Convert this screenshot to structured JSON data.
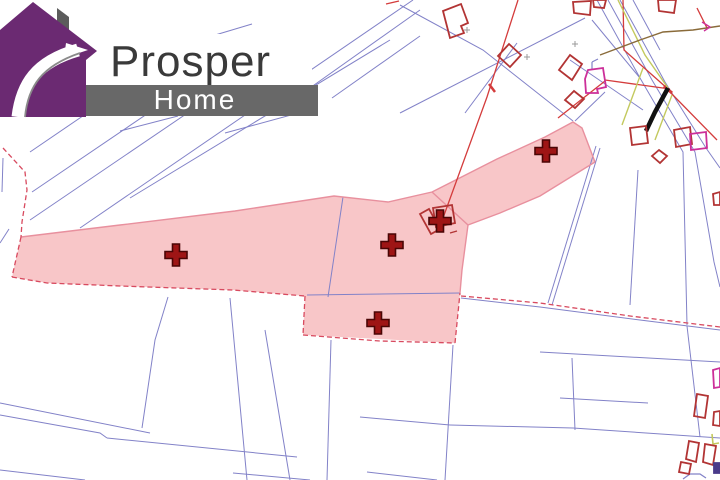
{
  "logo": {
    "title": "Prosper",
    "subtitle": "Home",
    "house_color": "#6b2a72",
    "chimney_color": "#5c5c5c",
    "banner_color": "#686868",
    "title_color": "#3a3a3a",
    "subtitle_color": "#ffffff",
    "swoosh_edge_color": "#8a8a8a"
  },
  "map": {
    "background": "#ffffff",
    "colors": {
      "parcel_line": "#8282c8",
      "highlight_fill": "#f8c6c8",
      "highlight_edge": "#e8909e",
      "highlight_dashed": "#d84a5f",
      "marker": "#9e1515",
      "marker_edge": "#4a0505",
      "building_red": "#b23434",
      "building_magenta": "#cc2f99",
      "building_purple": "#4a3a8a",
      "road_black": "#111111",
      "line_khaki": "#c3c95e",
      "line_brown": "#8a6b3a",
      "line_red": "#d43c3c",
      "tick_gray": "#9a9a9a"
    },
    "highlight_parcels": [
      "21,237 120,225 235,211 334,196 388,202 432,192 497,159 545,137 573,122 582,128 595,162 540,196 500,213 468,225 462,270 460,293 455,343 303,335 305,296 233,290 120,286 47,283 12,277"
    ],
    "outline_solid": [
      "21,237 120,225 235,211 334,196 388,202 432,192",
      "432,192 497,159 545,137 573,122 582,128 595,162",
      "595,162 540,196 500,213 468,225 462,270 460,293",
      "432,192 468,225"
    ],
    "dashed_lines": [
      "3,148 25,172 27,190 22,222 21,237",
      "21,237 12,277",
      "12,277 47,283 120,286 233,290 305,296",
      "305,296 303,335",
      "303,335 380,341 455,343",
      "455,343 460,293",
      "461,296 540,303 630,316 720,327"
    ],
    "parcel_lines": [
      "30,152 96,107",
      "32,192 200,78",
      "30,220 270,57",
      "80,228 413,0",
      "130,198 390,40",
      "175,47 252,24",
      "120,131 178,116",
      "225,133 302,112",
      "300,95 420,10",
      "332,98 420,36",
      "400,113 585,18",
      "400,5 483,50 573,121",
      "465,113 517,43",
      "605,92 575,121",
      "570,60 643,110",
      "592,20 640,78",
      "597,0 640,78 683,152 687,325",
      "608,0 652,80 695,152 714,262 720,287",
      "620,0 665,82 706,148 720,168",
      "633,0 660,50",
      "600,148 552,305",
      "596,146 548,303",
      "638,170 630,305",
      "461,298 540,307 640,320 720,330",
      "540,352 720,362",
      "560,398 648,403",
      "360,417 450,425",
      "450,425 573,428 720,438",
      "572,358 575,430",
      "687,326 700,437",
      "0,403 150,433",
      "0,415 100,433 107,438",
      "107,438 297,457",
      "168,297 155,340 142,428",
      "230,298 247,480",
      "265,330 290,480",
      "0,470 85,480",
      "233,473 310,480",
      "331,340 327,480",
      "453,345 445,480",
      "367,472 437,480",
      "3,158 2,192",
      "0,243 9,229",
      "343,197 328,297",
      "307,295 460,293"
    ],
    "extra_lines": [
      {
        "c": "line_red",
        "w": 1.3,
        "p": "518,0 487,97 443,218"
      },
      {
        "c": "line_red",
        "w": 2.5,
        "p": "489,84 495,92"
      },
      {
        "c": "line_red",
        "w": 1.3,
        "p": "386,4 399,1"
      },
      {
        "c": "line_red",
        "w": 1.3,
        "p": "623,0 624,50 668,89"
      },
      {
        "c": "line_red",
        "w": 1.3,
        "p": "668,90 717,140"
      },
      {
        "c": "line_red",
        "w": 1.3,
        "p": "605,80 670,89"
      },
      {
        "c": "line_red",
        "w": 1.3,
        "p": "558,118 605,81"
      },
      {
        "c": "line_red",
        "w": 1.3,
        "p": "697,8 707,28"
      },
      {
        "c": "line_red",
        "w": 3,
        "p": "664,86 672,93"
      },
      {
        "c": "line_khaki",
        "w": 1.4,
        "p": "618,0 645,55 668,88"
      },
      {
        "c": "line_khaki",
        "w": 1.4,
        "p": "643,68 622,125"
      },
      {
        "c": "line_khaki",
        "w": 1.4,
        "p": "672,95 655,140"
      },
      {
        "c": "line_khaki",
        "w": 1.6,
        "p": "712,434 713,444 719,443"
      },
      {
        "c": "line_brown",
        "w": 1.4,
        "p": "600,55 640,40 663,32 693,30 720,26"
      },
      {
        "c": "road_black",
        "w": 4.5,
        "p": "668,88 655,112 646,131"
      },
      {
        "c": "tick_gray",
        "w": 1,
        "p": "464,30 470,30"
      },
      {
        "c": "tick_gray",
        "w": 1,
        "p": "467,27 467,33"
      },
      {
        "c": "tick_gray",
        "w": 1,
        "p": "524,57 530,57"
      },
      {
        "c": "tick_gray",
        "w": 1,
        "p": "527,54 527,60"
      },
      {
        "c": "tick_gray",
        "w": 1,
        "p": "572,44 578,44"
      },
      {
        "c": "tick_gray",
        "w": 1,
        "p": "575,41 575,47"
      },
      {
        "c": "building_magenta",
        "w": 1.4,
        "p": "702,22 710,27 704,31"
      },
      {
        "c": "parcel_line",
        "w": 1.2,
        "p": "592,62 592,70"
      },
      {
        "c": "parcel_line",
        "w": 1.2,
        "p": "592,62 598,59"
      },
      {
        "c": "building_red",
        "w": 1.4,
        "p": "450,233 457,231"
      },
      {
        "c": "parcel_line",
        "w": 1.2,
        "p": "683,479 690,474 700,474 706,478"
      }
    ],
    "buildings": [
      {
        "c": "red",
        "p": "443,11 461,4 468,23 461,26 464,33 450,38"
      },
      {
        "c": "red",
        "p": "509,44 521,55 510,67 498,56"
      },
      {
        "c": "red",
        "p": "570,55 582,64 572,80 559,70"
      },
      {
        "c": "magenta",
        "p": "588,70 603,68 606,87 597,89 598,93 586,93 585,79"
      },
      {
        "c": "red",
        "p": "574,91 584,99 575,108 565,100"
      },
      {
        "c": "red",
        "p": "630,128 646,126 648,143 632,145"
      },
      {
        "c": "red",
        "p": "674,130 690,127 692,144 676,147"
      },
      {
        "c": "magenta",
        "p": "690,134 706,132 707,148 691,150"
      },
      {
        "c": "red",
        "p": "659,150 667,156 660,163 652,156"
      },
      {
        "c": "red",
        "p": "713,194 720,192 720,205 714,205"
      },
      {
        "c": "red",
        "p": "658,0 676,0 674,13 659,11"
      },
      {
        "c": "red",
        "p": "573,2 591,1 590,15 574,13"
      },
      {
        "c": "red",
        "p": "593,0 606,0 604,8 594,7"
      },
      {
        "c": "magenta",
        "p": "713,370 720,368 720,387 714,388"
      },
      {
        "c": "red",
        "p": "697,394 708,396 705,418 694,416"
      },
      {
        "c": "red",
        "p": "714,412 720,411 720,426 713,425"
      },
      {
        "c": "red",
        "p": "689,441 699,443 696,462 686,459"
      },
      {
        "c": "red",
        "p": "705,444 716,446 713,465 703,462"
      },
      {
        "c": "red",
        "p": "681,462 691,464 689,474 679,472"
      },
      {
        "c": "purple",
        "p": "714,463 720,463 720,473 714,473"
      },
      {
        "c": "red",
        "p": "420,214 429,209 440,229 431,234"
      },
      {
        "c": "red",
        "p": "433,208 452,205 455,223 436,227"
      }
    ],
    "markers": [
      {
        "x": 176,
        "y": 255
      },
      {
        "x": 392,
        "y": 245
      },
      {
        "x": 440,
        "y": 221
      },
      {
        "x": 378,
        "y": 323
      },
      {
        "x": 546,
        "y": 151
      }
    ]
  }
}
